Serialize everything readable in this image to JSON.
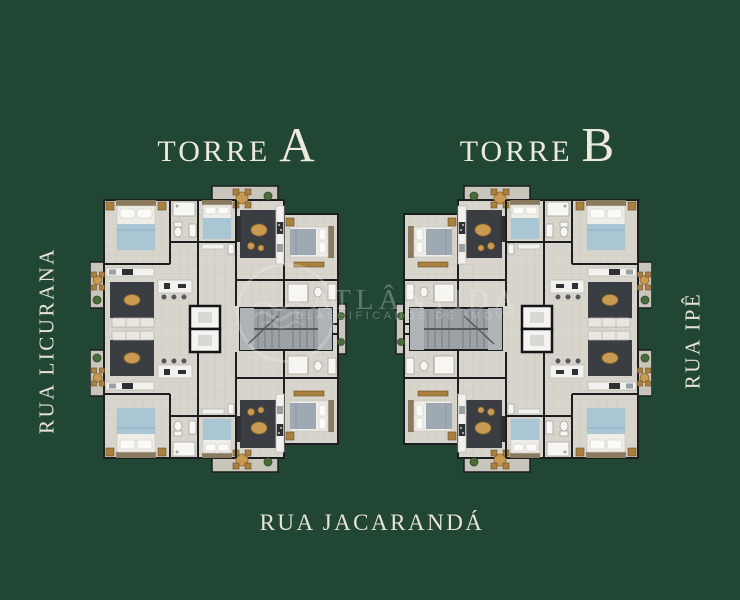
{
  "towers": {
    "a": {
      "prefix": "TORRE",
      "letter": "A"
    },
    "b": {
      "prefix": "TORRE",
      "letter": "B"
    }
  },
  "streets": {
    "left": "RUA LICURANA",
    "right": "RUA IPÊ",
    "bottom": "RUA JACARANDÁ"
  },
  "watermark": {
    "brand": "ATLÂNTIDA",
    "tagline": "CLASSIFICADOS DE IMÓVEIS"
  },
  "colors": {
    "background": "#214634",
    "label_text": "#ECEADD",
    "watermark_text": "rgba(238,242,238,0.30)",
    "floor": "#D8D5CD",
    "balcony_floor": "#C8C5BB",
    "wall": "#1C1D1F",
    "rug": "#3A3E42",
    "wood_accent": "#C89A52",
    "bed_blue": "#A9C6D4",
    "bed_gray": "#9FA9B3",
    "stairs": "#9BA1A4",
    "plant": "#4A6B3A"
  }
}
